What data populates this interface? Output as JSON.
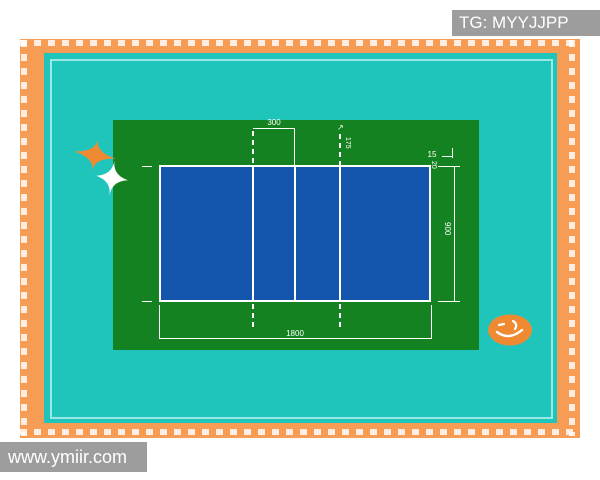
{
  "overlay": {
    "tg_label": "TG: MYYJJPP",
    "site_label": "www.ymiir.com"
  },
  "court": {
    "labels": {
      "attack_to_center": "300",
      "attack_extension": "175",
      "service_mark_length": "15",
      "service_mark_offset": "20",
      "court_width": "900",
      "court_length": "1800",
      "arrow": "↗"
    },
    "colors": {
      "frame_orange": "#F79C54",
      "background_cyan": "#1FC4BB",
      "surround_green": "#148221",
      "court_blue": "#1456AE",
      "line_white": "#FFFFFF",
      "accent_orange": "#F08A32",
      "watermark_gray": "#909090"
    }
  }
}
